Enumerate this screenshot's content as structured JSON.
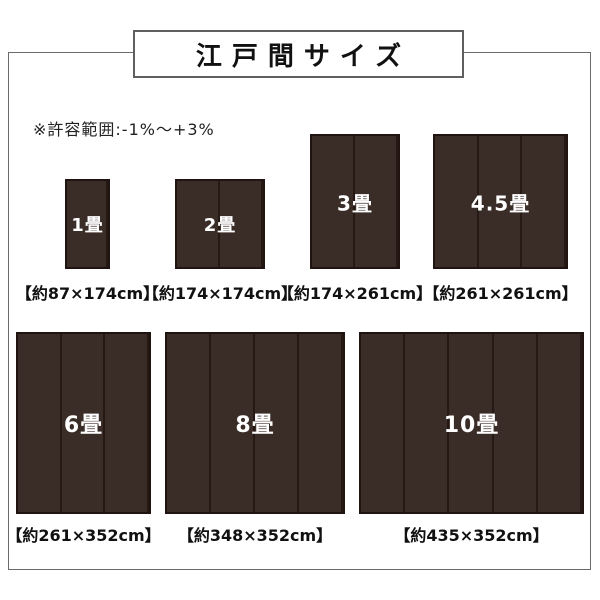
{
  "page": {
    "title": "江戸間サイズ",
    "tolerance_note": "※許容範囲:-1%〜+3%",
    "colors": {
      "mat_fill": "#3a2c27",
      "mat_border": "#1f1410",
      "mat_divider": "#261813",
      "frame_border": "#6b6b6b",
      "title_box_border": "#5f5f5f",
      "text": "#111111",
      "mat_label_text": "#ffffff"
    }
  },
  "mats": [
    {
      "id": "1jo",
      "label": "1畳",
      "size_label": "【約87×174cm】",
      "width_cm": 87,
      "height_cm": 174,
      "panels": 1
    },
    {
      "id": "2jo",
      "label": "2畳",
      "size_label": "【約174×174cm】",
      "width_cm": 174,
      "height_cm": 174,
      "panels": 2
    },
    {
      "id": "3jo",
      "label": "3畳",
      "size_label": "【約174×261cm】",
      "width_cm": 174,
      "height_cm": 261,
      "panels": 2
    },
    {
      "id": "45jo",
      "label": "4.5畳",
      "size_label": "【約261×261cm】",
      "width_cm": 261,
      "height_cm": 261,
      "panels": 3
    },
    {
      "id": "6jo",
      "label": "6畳",
      "size_label": "【約261×352cm】",
      "width_cm": 261,
      "height_cm": 352,
      "panels": 3
    },
    {
      "id": "8jo",
      "label": "8畳",
      "size_label": "【約348×352cm】",
      "width_cm": 348,
      "height_cm": 352,
      "panels": 4
    },
    {
      "id": "10jo",
      "label": "10畳",
      "size_label": "【約435×352cm】",
      "width_cm": 435,
      "height_cm": 352,
      "panels": 5
    }
  ]
}
